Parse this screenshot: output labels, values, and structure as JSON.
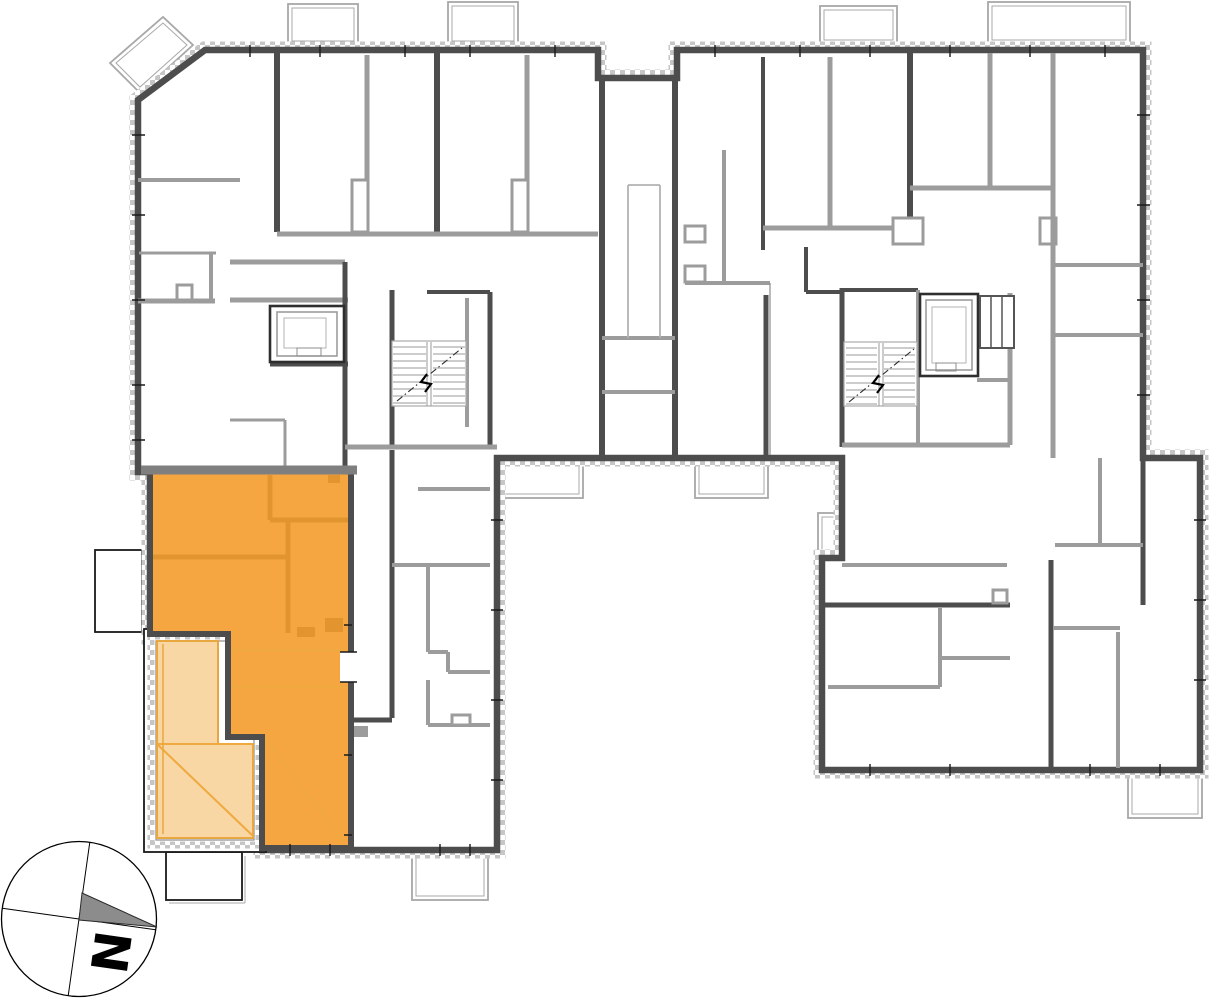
{
  "compass": {
    "north_label": "N"
  },
  "colors": {
    "background": "#FFFFFF",
    "unit_highlight": "#F5A640",
    "unit_partition": "#E2952F",
    "terrace_fill": "#F8D7A4",
    "terrace_accent": "#EFA93E",
    "wall_dark": "#4D4D4D",
    "wall_medium": "#9C9C9C",
    "hatch_gray": "#C6C6C6",
    "balcony_outline": "#A8A8A8",
    "north_arrow_gray": "#8C8C8C"
  },
  "icons": {
    "compass_rose": "compass-rose",
    "north_arrow": "north-arrow-icon",
    "stairs": "stairs-icon",
    "elevator": "elevator-icon"
  }
}
